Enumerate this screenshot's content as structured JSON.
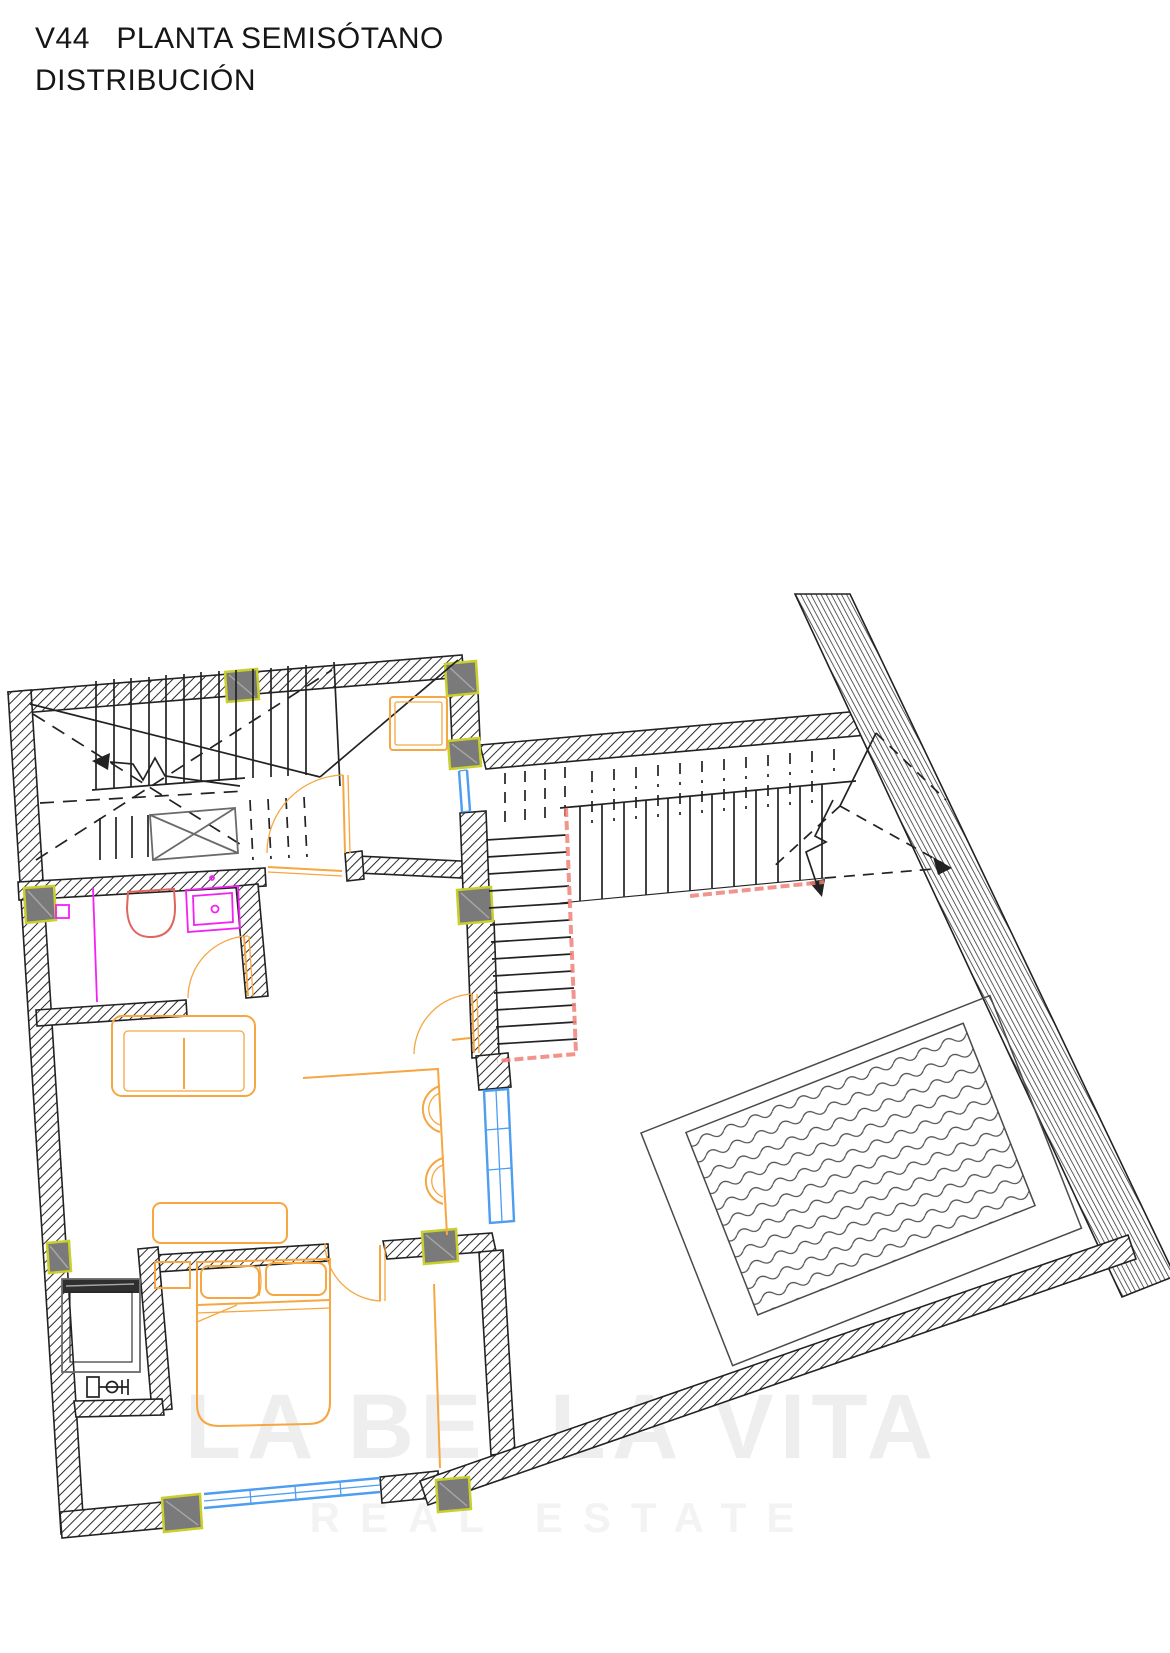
{
  "header": {
    "title_line1": "V44   PLANTA SEMISÓTANO",
    "title_line2": "DISTRIBUCIÓN"
  },
  "watermark": {
    "line1": "LA BELLA VITA",
    "line2": "REAL ESTATE"
  },
  "colors": {
    "title": "#161616",
    "ink": "#222222",
    "column_fill": "#7a7a7a",
    "column_border": "#c9cf2d",
    "furniture_orange": "#f6a642",
    "plumbing_magenta": "#f520f5",
    "toilet_salmon": "#e0655c",
    "handrail_red": "#f08078",
    "glazing_blue": "#4d9df0",
    "pool_line": "#4a4a4a",
    "watermark_gray": "#8f8f8f"
  }
}
